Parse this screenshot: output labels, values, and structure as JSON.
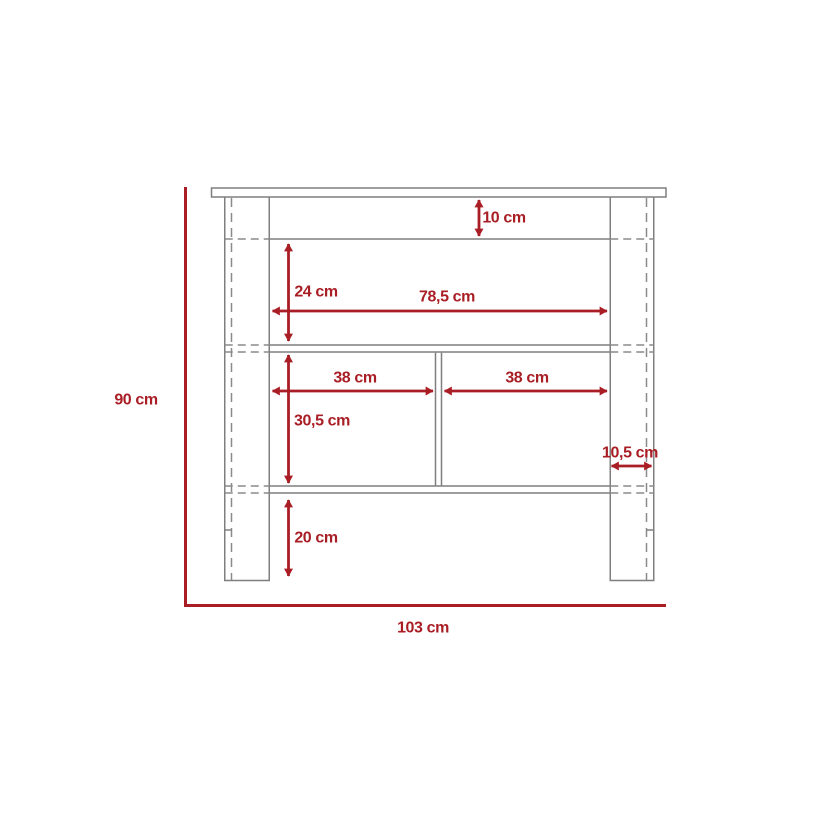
{
  "diagram": {
    "unit": "cm",
    "colors": {
      "dimension_red": "#a91e25",
      "outline_gray": "#7f7f7f",
      "background": "#ffffff"
    },
    "labels": {
      "top_inset": "10 cm",
      "upper_section_height": "24 cm",
      "upper_section_width": "78,5 cm",
      "left_compartment_width": "38 cm",
      "right_compartment_width": "38 cm",
      "lower_section_height": "30,5 cm",
      "right_overhang": "10,5 cm",
      "leg_clearance_height": "20 cm",
      "total_height": "90 cm",
      "total_width": "103 cm"
    }
  }
}
